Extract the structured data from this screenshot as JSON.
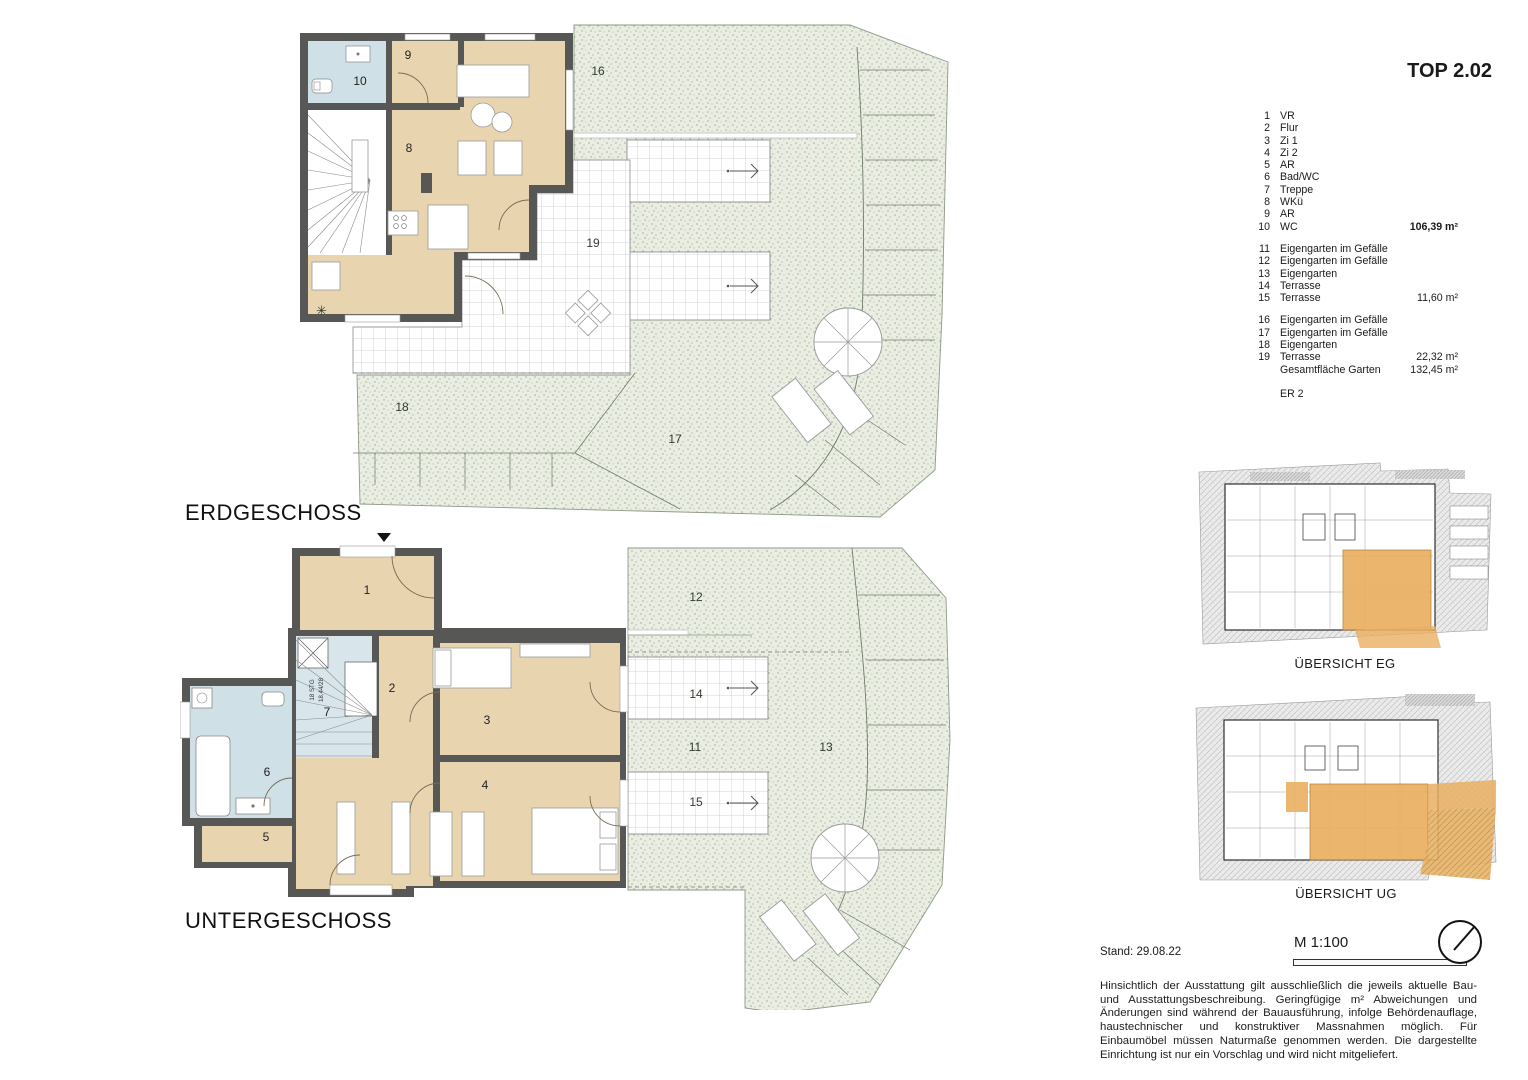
{
  "title": "TOP 2.02",
  "plans": {
    "eg": {
      "label": "ERDGESCHOSS",
      "rooms": {
        "r8": "8",
        "r9": "9",
        "r10": "10",
        "r16": "16",
        "r17": "17",
        "r18": "18",
        "r19": "19"
      }
    },
    "ug": {
      "label": "UNTERGESCHOSS",
      "stair_steps": "18 STG",
      "stair_dim": "18,44/28",
      "rooms": {
        "r1": "1",
        "r2": "2",
        "r3": "3",
        "r4": "4",
        "r5": "5",
        "r6": "6",
        "r7": "7",
        "r11": "11",
        "r12": "12",
        "r13": "13",
        "r14": "14",
        "r15": "15"
      }
    }
  },
  "legend": {
    "groups": [
      {
        "items": [
          {
            "n": "1",
            "t": "VR"
          },
          {
            "n": "2",
            "t": "Flur"
          },
          {
            "n": "3",
            "t": "Zi 1"
          },
          {
            "n": "4",
            "t": "Zi 2"
          },
          {
            "n": "5",
            "t": "AR"
          },
          {
            "n": "6",
            "t": "Bad/WC"
          },
          {
            "n": "7",
            "t": "Treppe"
          },
          {
            "n": "8",
            "t": "WKü"
          },
          {
            "n": "9",
            "t": "AR"
          },
          {
            "n": "10",
            "t": "WC",
            "area": "106,39 m²",
            "bold": true
          }
        ]
      },
      {
        "items": [
          {
            "n": "11",
            "t": "Eigengarten im Gefälle"
          },
          {
            "n": "12",
            "t": "Eigengarten im Gefälle"
          },
          {
            "n": "13",
            "t": "Eigengarten"
          },
          {
            "n": "14",
            "t": "Terrasse"
          },
          {
            "n": "15",
            "t": "Terrasse",
            "area": "11,60 m²"
          }
        ]
      },
      {
        "items": [
          {
            "n": "16",
            "t": "Eigengarten im Gefälle"
          },
          {
            "n": "17",
            "t": "Eigengarten im Gefälle"
          },
          {
            "n": "18",
            "t": "Eigengarten"
          },
          {
            "n": "19",
            "t": "Terrasse",
            "area": "22,32 m²"
          },
          {
            "n": "",
            "t": "Gesamtfläche Garten",
            "area": "132,45 m²"
          }
        ]
      }
    ],
    "er_label": "ER 2"
  },
  "overviews": [
    {
      "label": "ÜBERSICHT EG"
    },
    {
      "label": "ÜBERSICHT UG"
    }
  ],
  "footer": {
    "stand": "Stand: 29.08.22",
    "scale": "M 1:100",
    "disclaimer": "Hinsichtlich der Ausstattung gilt ausschließlich die jeweils aktuelle Bau- und Ausstattungsbeschreibung. Geringfügige m² Abweichungen und Änderungen sind während der Bauausführung, infolge Behördenauflage, haustechnischer und konstruktiver Massnahmen möglich. Für Einbaumöbel müssen Naturmaße genommen werden. Die dargestellte Einrichtung ist nur ein Vorschlag und wird nicht mitgeliefert."
  },
  "colors": {
    "wall": "#575756",
    "room_beige": "#e8d5b0",
    "wet_blue": "#cfe0e6",
    "stair_blue": "#d8e6ec",
    "garden": "#e9ede2",
    "highlight_orange": "#eaaf62"
  }
}
